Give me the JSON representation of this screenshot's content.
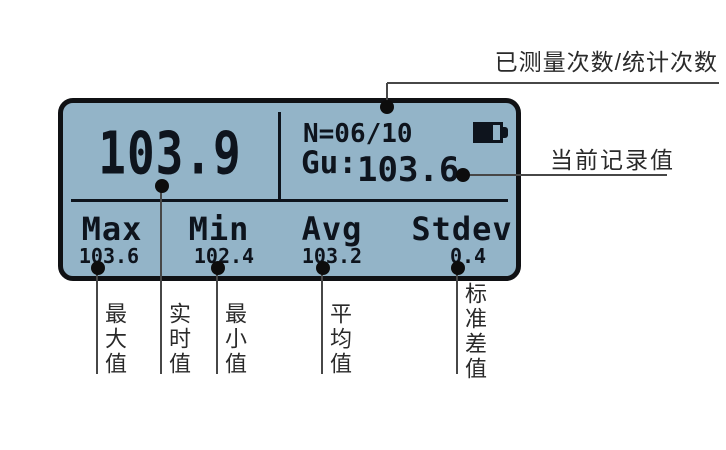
{
  "lcd": {
    "main_value": "103.9",
    "counter": "N=06/10",
    "record_label": "Gu:",
    "record_value": "103.6",
    "battery": {
      "level_percent": 72
    },
    "stats": [
      {
        "label": "Max",
        "value": "103.6"
      },
      {
        "label": "Min",
        "value": "102.4"
      },
      {
        "label": "Avg",
        "value": "103.2"
      },
      {
        "label": "Stdev",
        "value": "0.4"
      }
    ]
  },
  "annotations": {
    "measured_count": "已测量次数/统计次数",
    "current_record": "当前记录值",
    "stat_labels": [
      "最大值",
      "实时值",
      "最小值",
      "平均值",
      "标准差值"
    ]
  },
  "colors": {
    "lcd_background": "#93b4c8",
    "lcd_ink": "#0e141d",
    "bezel": "#101114",
    "leader_line": "#474747",
    "annotation_text": "#2a2a2a"
  }
}
